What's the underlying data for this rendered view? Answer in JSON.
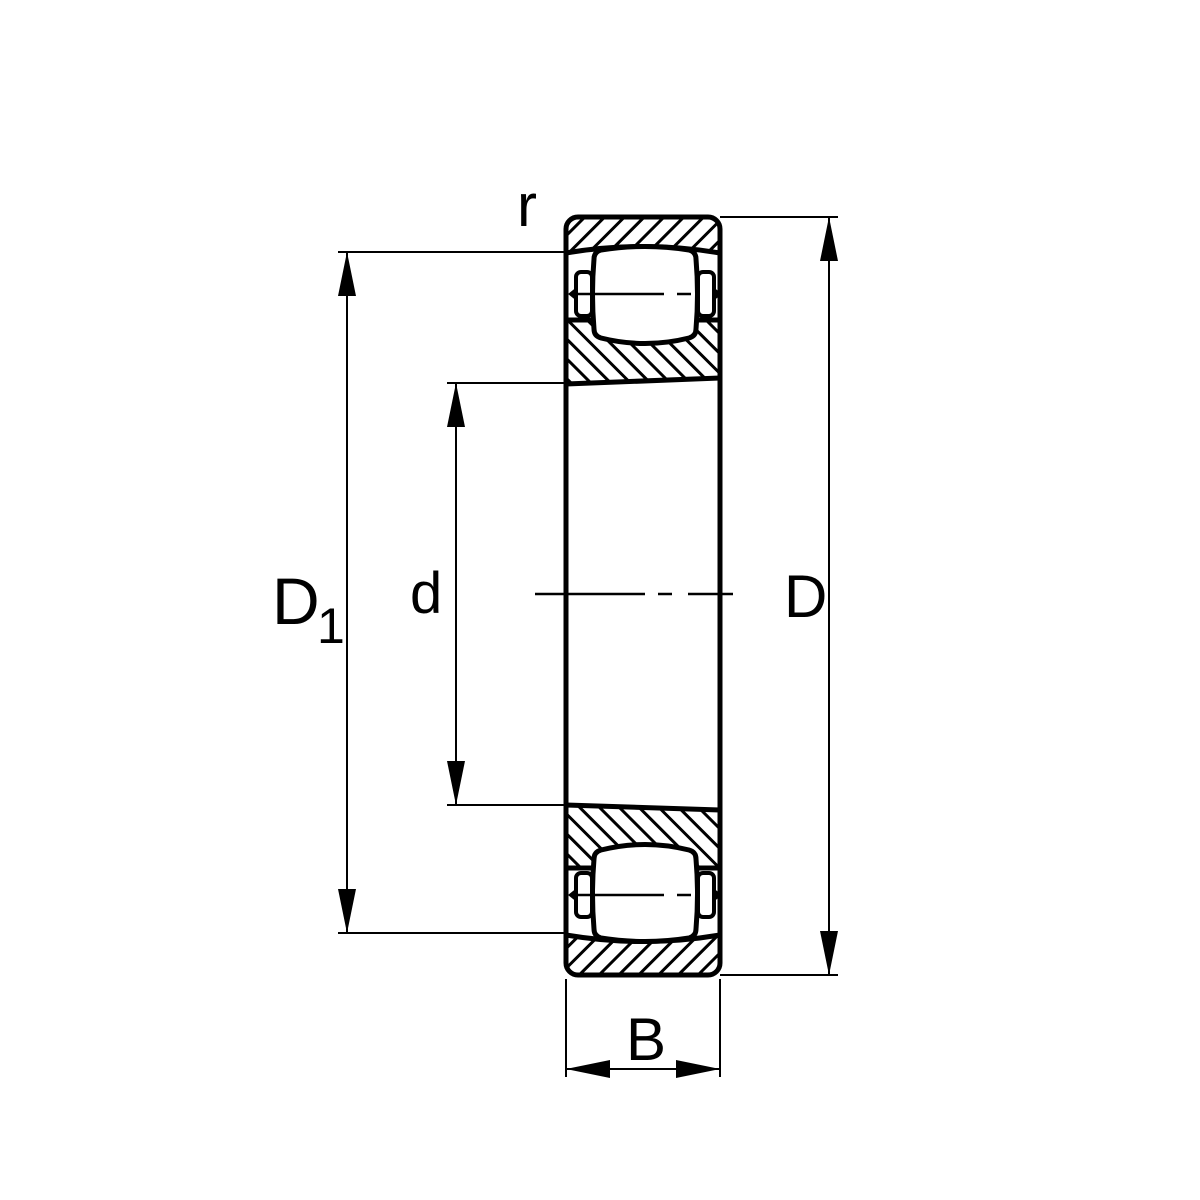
{
  "diagram": {
    "labels": {
      "chamfer": "r",
      "d1_main": "D",
      "d1_sub": "1",
      "bore_diameter": "d",
      "outer_diameter": "D",
      "width": "B"
    },
    "colors": {
      "line": "#000000",
      "background": "#ffffff"
    }
  }
}
